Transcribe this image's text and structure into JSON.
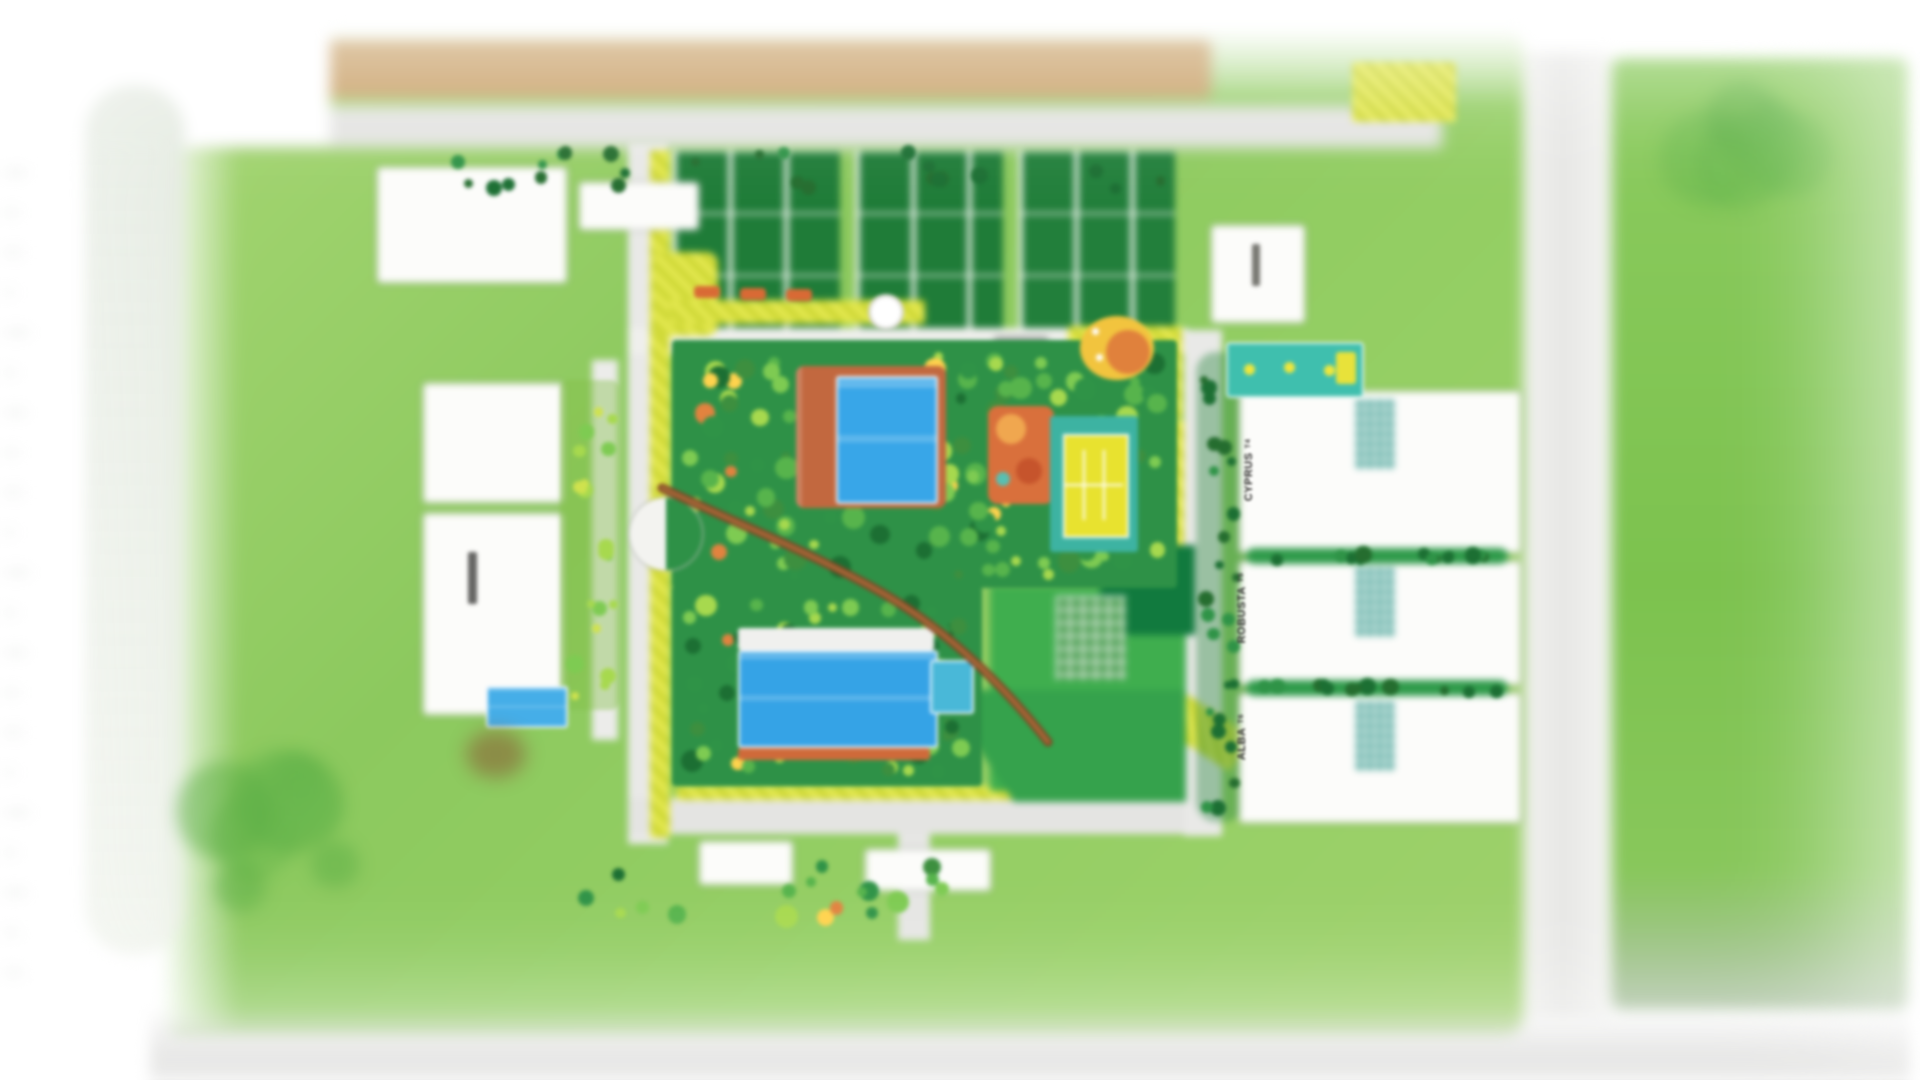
{
  "page": {
    "description": "Blurred aerial master-plan rendering of a landscaped residential complex",
    "background": "#ffffff"
  },
  "palette": {
    "field_green": "#93ce63",
    "lawn_dark_green": "#1f7c38",
    "grass_bright": "#3fae4e",
    "pool_blue": "#38a6e8",
    "court_teal": "#3db3a2",
    "court_yellow": "#e8e22f",
    "path_yellow": "#dde04a",
    "deck_terracotta": "#c2683f",
    "canopy_walk_brown": "#7d4522",
    "road_gray": "#e4e4e2",
    "boulevard_tan": "#c9a169",
    "tree_colors": [
      "#1c6f33",
      "#2f9347",
      "#57b44c",
      "#7ecb52",
      "#a7d94e",
      "#3d8f3f"
    ],
    "tree_accent_colors": [
      "#ffd34d",
      "#e2833f"
    ]
  },
  "plan": {
    "towers": [
      {
        "name": "CYPRUS",
        "code": "T4"
      },
      {
        "name": "ROBUSTA",
        "code": "T5"
      },
      {
        "name": "ALBA",
        "code": "T6"
      }
    ],
    "amenities": [
      "central-garden",
      "north-pool",
      "south-pool",
      "kids-pool",
      "lap-pool",
      "west-pool",
      "tennis-court",
      "playground",
      "kids-play-area",
      "pergola-walk",
      "fountain-plaza",
      "round-plaza",
      "canopy-walk",
      "boulevard",
      "formal-garden",
      "east-lawn"
    ]
  }
}
